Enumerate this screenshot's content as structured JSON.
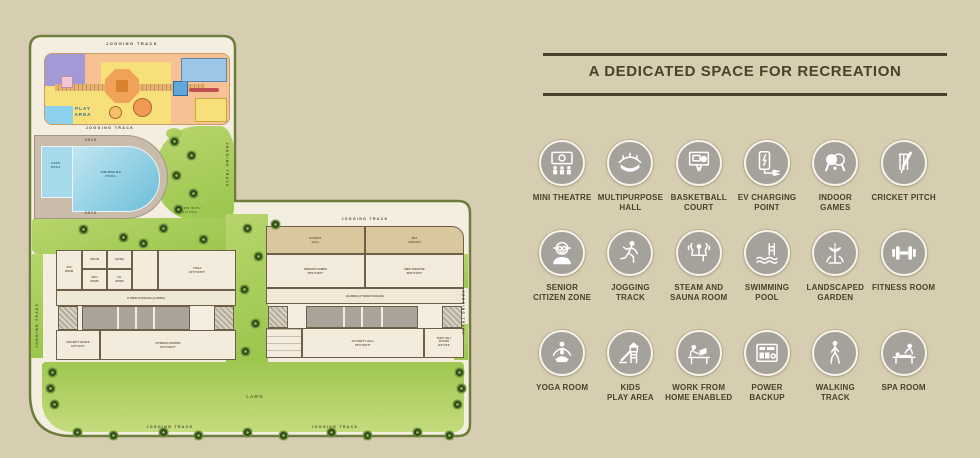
{
  "plan": {
    "labels": {
      "jogging_track": "JOGGING TRACK",
      "play_area": "PLAY\nAREA",
      "deck": "DECK",
      "kids_pool": "KIDS\nPOOL",
      "swimming_pool": "SWIMMING\nPOOL",
      "lawn_with_sitting": "LAWN WITH\nSITTING",
      "basket_ball": "BASKET\nBALL",
      "net_cricket": "NET\nCRICKET",
      "indoor_games": "INDOOR GAMES\n58'9\"X16'6\"",
      "mini_theatre": "MINI THEATRE\n58'9\"X16'6\"",
      "yoga": "YOGA\n24'0\"X16'6\"",
      "passage_a": "8' WIDE PASSAGE (A-WING)",
      "passage_b": "(B-WING) 8' WIDE PASSAGE",
      "security_office": "SECURITY OFFICE\n10'0\"X10'0\"",
      "fitness_centre": "FITNESS CENTRE\n61'0\"X16'0\"",
      "ac_party_hall": "AC PARTY HALL\n65'0\"X16'0\"",
      "party_hall_kitchen": "PARTY HALL\nKITCHEN\n19'0\"X16'6\"",
      "lawn": "LAWN",
      "small_rooms": [
        "SPA\nROOM",
        "STEAM",
        "SAUNA",
        "WFH\nROOM",
        "CH.\nROOM"
      ]
    }
  },
  "recreation": {
    "title": "A DEDICATED SPACE FOR RECREATION",
    "accent_color": "#4c4228",
    "icon_bg_color": "#a5a19b",
    "items": [
      {
        "icon": "mini-theatre-icon",
        "label": "MINI THEATRE"
      },
      {
        "icon": "multipurpose-hall-icon",
        "label": "MULTIPURPOSE\nHALL"
      },
      {
        "icon": "basketball-court-icon",
        "label": "BASKETBALL\nCOURT"
      },
      {
        "icon": "ev-charging-icon",
        "label": "EV CHARGING\nPOINT"
      },
      {
        "icon": "indoor-games-icon",
        "label": "INDOOR\nGAMES"
      },
      {
        "icon": "cricket-pitch-icon",
        "label": "CRICKET PITCH"
      },
      {
        "icon": "senior-citizen-icon",
        "label": "SENIOR\nCITIZEN ZONE"
      },
      {
        "icon": "jogging-track-icon",
        "label": "JOGGING TRACK"
      },
      {
        "icon": "steam-sauna-icon",
        "label": "STEAM AND\nSAUNA ROOM"
      },
      {
        "icon": "swimming-pool-icon",
        "label": "SWIMMING POOL"
      },
      {
        "icon": "landscaped-garden-icon",
        "label": "LANDSCAPED\nGARDEN"
      },
      {
        "icon": "fitness-room-icon",
        "label": "FITNESS ROOM"
      },
      {
        "icon": "yoga-room-icon",
        "label": "YOGA ROOM"
      },
      {
        "icon": "kids-play-area-icon",
        "label": "KIDS\nPLAY AREA"
      },
      {
        "icon": "work-from-home-icon",
        "label": "WORK FROM\nHOME ENABLED"
      },
      {
        "icon": "power-backup-icon",
        "label": "POWER BACKUP"
      },
      {
        "icon": "walking-track-icon",
        "label": "WALKING\nTRACK"
      },
      {
        "icon": "spa-room-icon",
        "label": "SPA ROOM"
      }
    ]
  }
}
